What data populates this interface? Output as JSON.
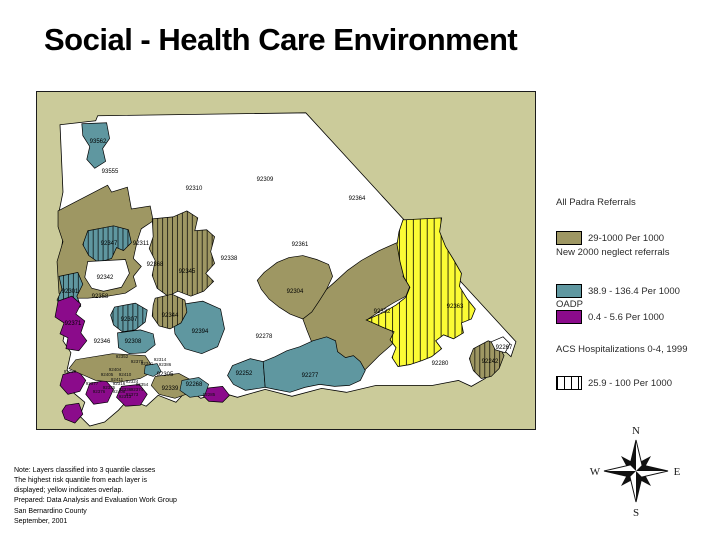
{
  "slide": {
    "title": "Social - Health Care Environment"
  },
  "legend": {
    "section1_heading": "All Padra Referrals",
    "item1_label": "29-1000 Per 1000",
    "section2_heading": "New 2000 neglect referrals",
    "item2_label": "38.9 - 136.4 Per 1000",
    "section3_heading": "OADP",
    "item3_label": "0.4 - 5.6 Per 1000",
    "section4_heading": "ACS Hospitalizations 0-4, 1999",
    "item4_label": "25.9 - 100 Per 1000"
  },
  "colors": {
    "padra_khaki": "#9e9763",
    "neglect_teal": "#5f97a0",
    "oadp_purple": "#8b0b8b",
    "overlap_yellow": "#fbfb35",
    "map_background": "#cbcb9a",
    "county_white": "#ffffff",
    "outline_black": "#000000"
  },
  "compass": {
    "n": "N",
    "s": "S",
    "e": "E",
    "w": "W"
  },
  "notes": {
    "lines": [
      "Note:  Layers classified into 3 quantile classes",
      "The highest risk quantile from each layer is",
      "displayed; yellow indicates overlap.",
      "Prepared:  Data Analysis and Evaluation Work Group",
      "San Bernardino County",
      "September, 2001"
    ]
  },
  "map": {
    "zip_labels": [
      {
        "t": "93562",
        "x": 61,
        "y": 50
      },
      {
        "t": "93555",
        "x": 73,
        "y": 80
      },
      {
        "t": "92310",
        "x": 157,
        "y": 97
      },
      {
        "t": "92309",
        "x": 228,
        "y": 88
      },
      {
        "t": "92364",
        "x": 320,
        "y": 107
      },
      {
        "t": "92361",
        "x": 263,
        "y": 153
      },
      {
        "t": "92338",
        "x": 192,
        "y": 167
      },
      {
        "t": "92311",
        "x": 104,
        "y": 152
      },
      {
        "t": "92347",
        "x": 72,
        "y": 152
      },
      {
        "t": "92345",
        "x": 150,
        "y": 180
      },
      {
        "t": "92342",
        "x": 68,
        "y": 186
      },
      {
        "t": "92368",
        "x": 118,
        "y": 173
      },
      {
        "t": "92301",
        "x": 33,
        "y": 200
      },
      {
        "t": "92358",
        "x": 63,
        "y": 205
      },
      {
        "t": "92344",
        "x": 133,
        "y": 224
      },
      {
        "t": "92307",
        "x": 92,
        "y": 228
      },
      {
        "t": "92371",
        "x": 36,
        "y": 232
      },
      {
        "t": "92308",
        "x": 96,
        "y": 250
      },
      {
        "t": "92394",
        "x": 163,
        "y": 240
      },
      {
        "t": "92346",
        "x": 65,
        "y": 250
      },
      {
        "t": "92304",
        "x": 258,
        "y": 200
      },
      {
        "t": "92332",
        "x": 345,
        "y": 220
      },
      {
        "t": "92363",
        "x": 418,
        "y": 215
      },
      {
        "t": "92280",
        "x": 403,
        "y": 272
      },
      {
        "t": "92242",
        "x": 453,
        "y": 270
      },
      {
        "t": "92267",
        "x": 467,
        "y": 256
      },
      {
        "t": "92278",
        "x": 227,
        "y": 245
      },
      {
        "t": "92252",
        "x": 207,
        "y": 282
      },
      {
        "t": "92277",
        "x": 273,
        "y": 284
      },
      {
        "t": "92268",
        "x": 157,
        "y": 293
      },
      {
        "t": "92305",
        "x": 128,
        "y": 283
      },
      {
        "t": "92339",
        "x": 133,
        "y": 297
      },
      {
        "t": "92352",
        "x": 85,
        "y": 265,
        "s": 1
      },
      {
        "t": "92378",
        "x": 100,
        "y": 270,
        "s": 1
      },
      {
        "t": "92341",
        "x": 110,
        "y": 272,
        "s": 1
      },
      {
        "t": "92314",
        "x": 123,
        "y": 268,
        "s": 1
      },
      {
        "t": "92386",
        "x": 128,
        "y": 273,
        "s": 1
      },
      {
        "t": "91759",
        "x": 33,
        "y": 280,
        "s": 1
      },
      {
        "t": "92404",
        "x": 78,
        "y": 278,
        "s": 1
      },
      {
        "t": "92405",
        "x": 70,
        "y": 283,
        "s": 1
      },
      {
        "t": "92410",
        "x": 88,
        "y": 283,
        "s": 1
      },
      {
        "t": "92411",
        "x": 80,
        "y": 288,
        "s": 1
      },
      {
        "t": "92316",
        "x": 82,
        "y": 292,
        "s": 1
      },
      {
        "t": "92324",
        "x": 95,
        "y": 290,
        "s": 1
      },
      {
        "t": "92335",
        "x": 72,
        "y": 296,
        "s": 1
      },
      {
        "t": "92336",
        "x": 88,
        "y": 298,
        "s": 1
      },
      {
        "t": "92377",
        "x": 55,
        "y": 292,
        "s": 1
      },
      {
        "t": "92376",
        "x": 62,
        "y": 300,
        "s": 1
      },
      {
        "t": "92354",
        "x": 105,
        "y": 293,
        "s": 1
      },
      {
        "t": "92374",
        "x": 100,
        "y": 298,
        "s": 1
      },
      {
        "t": "92373",
        "x": 95,
        "y": 303,
        "s": 1
      },
      {
        "t": "92313",
        "x": 88,
        "y": 305,
        "s": 1
      },
      {
        "t": "92408",
        "x": 82,
        "y": 300,
        "s": 1
      },
      {
        "t": "92285",
        "x": 172,
        "y": 303,
        "s": 1
      }
    ]
  }
}
